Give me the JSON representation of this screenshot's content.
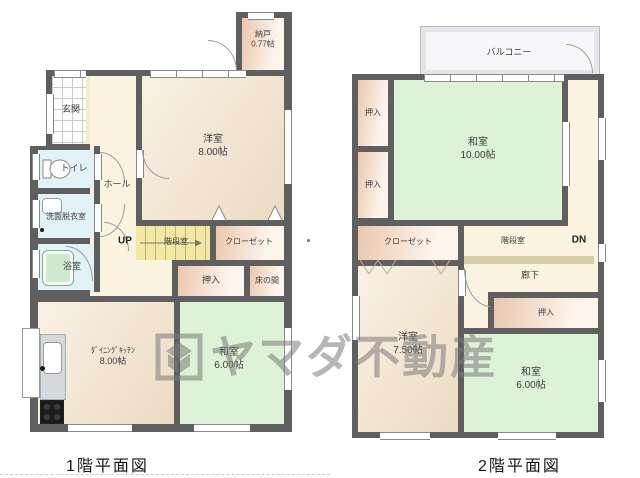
{
  "brand_watermark": "ヤマダ不動産",
  "floor1": {
    "caption": "1階平面図",
    "up_label": "UP",
    "rooms": {
      "nando": {
        "name": "納戸",
        "size": "0.77帖"
      },
      "genkan": {
        "name": "玄関"
      },
      "toilet": {
        "name": "トイレ"
      },
      "senmen": {
        "name": "洗面脱衣室"
      },
      "bath": {
        "name": "浴室"
      },
      "hall": {
        "name": "ホール"
      },
      "stairs": {
        "name": "階段室"
      },
      "closet": {
        "name": "クローゼット"
      },
      "oshiire": {
        "name": "押入"
      },
      "tokonoma": {
        "name": "床の間"
      },
      "western8": {
        "name": "洋室",
        "size": "8.00帖"
      },
      "dk": {
        "name": "ﾀﾞｲﾆﾝｸﾞｷｯﾁﾝ",
        "size": "8.00帖"
      },
      "japanese6": {
        "name": "和室",
        "size": "6.00帖"
      }
    }
  },
  "floor2": {
    "caption": "2階平面図",
    "down_label": "DN",
    "rooms": {
      "balcony": {
        "name": "バルコニー"
      },
      "oshiire_upper": {
        "name": "押入"
      },
      "oshiire_lower": {
        "name": "押入"
      },
      "japanese10": {
        "name": "和室",
        "size": "10.00帖"
      },
      "closet": {
        "name": "クローゼット"
      },
      "stairs": {
        "name": "階段室"
      },
      "corridor": {
        "name": "廊下"
      },
      "oshiire_south": {
        "name": "押入"
      },
      "western75": {
        "name": "洋室",
        "size": "7.50帖"
      },
      "japanese6": {
        "name": "和室",
        "size": "6.00帖"
      }
    }
  },
  "colors": {
    "wall": "#5f5f5f",
    "tatami_room": "#ddf2d6",
    "wood_room": "#f2e6d0",
    "storage": "#f0cdb6",
    "wet_area": "#e3f2f6",
    "stairs": "#f2e8a4",
    "hall": "#faf3e0",
    "corridor_strip": "#d8cda6"
  }
}
